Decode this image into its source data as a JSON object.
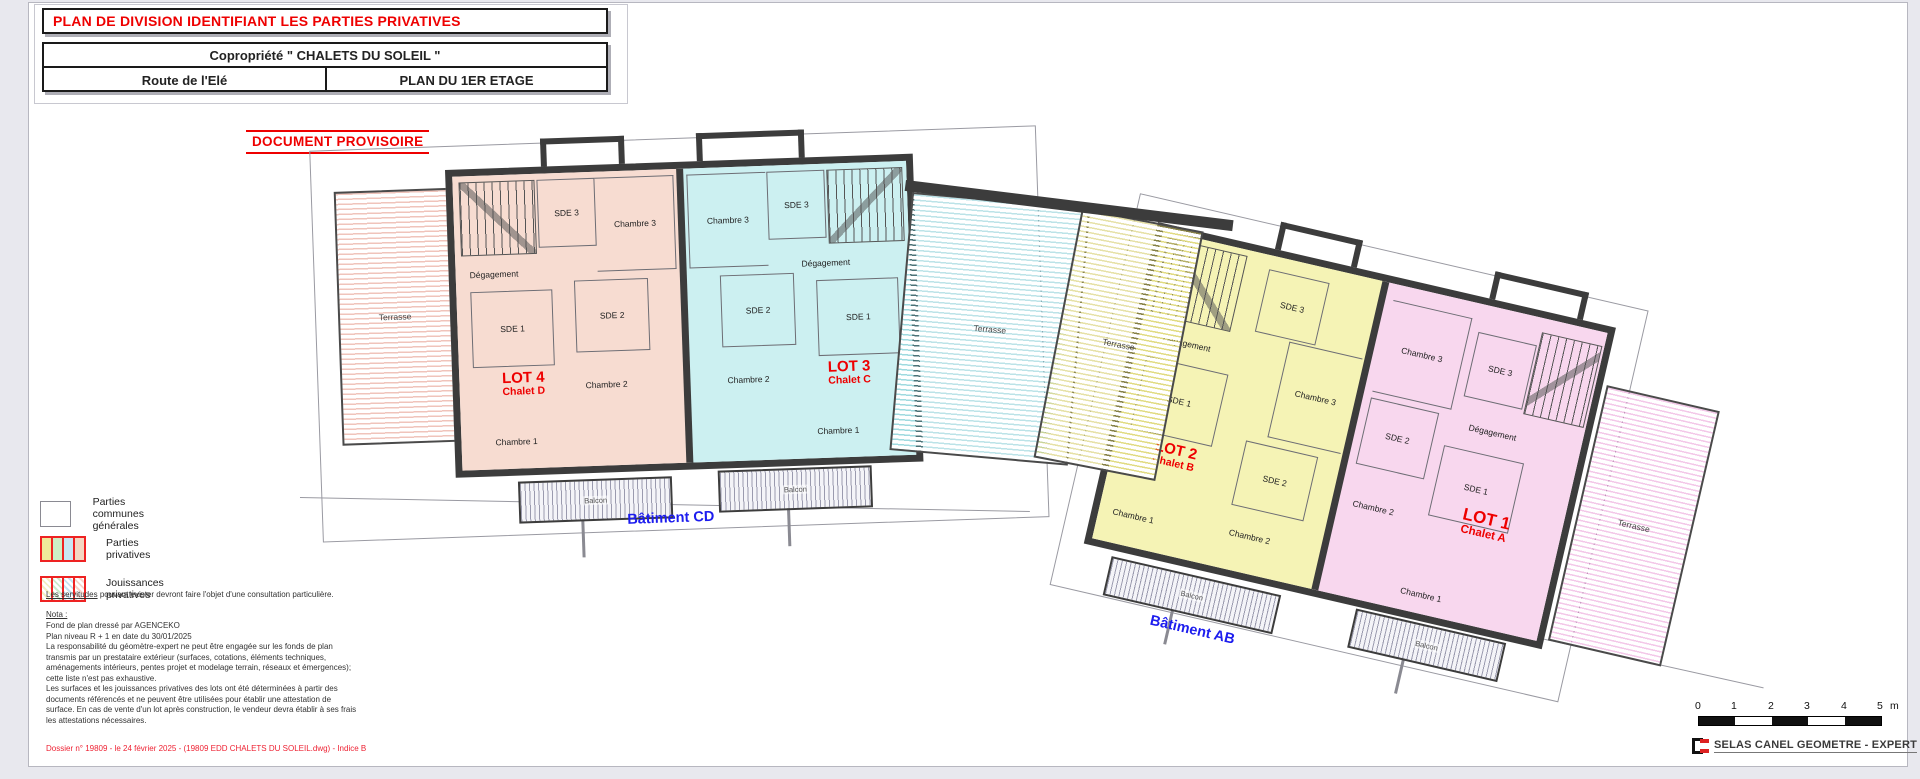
{
  "title_block": {
    "line1": "PLAN DE DIVISION IDENTIFIANT LES PARTIES PRIVATIVES",
    "line2": "Copropriété \" CHALETS DU SOLEIL \"",
    "line3_left": "Route de l'Elé",
    "line3_right": "PLAN DU 1ER ETAGE"
  },
  "stamp": "DOCUMENT PROVISOIRE",
  "colors": {
    "accent_red": "#ee0000",
    "label_blue": "#1c1cee",
    "chalet_d_fill": "#f7dcd1",
    "chalet_c_fill": "#ccf0f1",
    "chalet_b_fill": "#f5f3b5",
    "chalet_a_fill": "#f8d7ee"
  },
  "plan": {
    "batiment_cd": {
      "label": "Bâtiment CD",
      "terrasse_left": "Terrasse",
      "balcons": [
        "Balcon",
        "Balcon"
      ],
      "units": [
        {
          "lot": "LOT 4",
          "chalet": "Chalet D",
          "rooms": {
            "sde3": "SDE 3",
            "chambre3": "Chambre 3",
            "degagement": "Dégagement",
            "sde1": "SDE 1",
            "sde2": "SDE 2",
            "chambre2": "Chambre 2",
            "chambre1": "Chambre 1"
          }
        },
        {
          "lot": "LOT 3",
          "chalet": "Chalet C",
          "rooms": {
            "sde3": "SDE 3",
            "chambre3": "Chambre 3",
            "degagement": "Dégagement",
            "sde1": "SDE 1",
            "sde2": "SDE 2",
            "chambre2": "Chambre 2",
            "chambre1": "Chambre 1"
          }
        }
      ]
    },
    "terrasses_middle": [
      "Terrasse",
      "Terrasse"
    ],
    "batiment_ab": {
      "label": "Bâtiment AB",
      "terrasse_right": "Terrasse",
      "balcons": [
        "Balcon",
        "Balcon"
      ],
      "units": [
        {
          "lot": "LOT 2",
          "chalet": "Chalet B",
          "rooms": {
            "sde3": "SDE 3",
            "chambre3": "Chambre 3",
            "degagement": "Dégagement",
            "sde1": "SDE 1",
            "sde2": "SDE 2",
            "chambre2": "Chambre 2",
            "chambre1": "Chambre 1"
          }
        },
        {
          "lot": "LOT 1",
          "chalet": "Chalet A",
          "rooms": {
            "sde3": "SDE 3",
            "chambre3": "Chambre 3",
            "degagement": "Dégagement",
            "sde1": "SDE 1",
            "sde2": "SDE 2",
            "chambre2": "Chambre 2",
            "chambre1": "Chambre 1"
          }
        }
      ]
    }
  },
  "legend": {
    "items": [
      {
        "label": "Parties communes générales"
      },
      {
        "label": "Parties privatives"
      },
      {
        "label": "Jouissances privatives"
      }
    ]
  },
  "notes": {
    "servitudes_underlined": "Les servitudes",
    "servitudes_rest": " pouvant exister devront faire l'objet d'une consultation particulière.",
    "nota_title": "Nota :",
    "lines": [
      "Fond de plan dressé par AGENCEKO",
      "Plan niveau R + 1 en date du 30/01/2025",
      "La responsabilité du géomètre-expert ne peut être engagée sur les fonds de plan",
      "transmis par un prestataire extérieur (surfaces, cotations, éléments techniques,",
      "aménagements intérieurs, pentes projet et modelage terrain, réseaux et émergences);",
      "cette liste n'est pas exhaustive.",
      "Les surfaces et les jouissances privatives des lots ont été déterminées à partir des",
      "documents référencés et ne peuvent être utilisées pour établir une attestation de",
      "surface. En cas de vente d'un lot après construction, le vendeur devra établir à ses frais",
      "les attestations nécessaires."
    ],
    "dossier": "Dossier n° 19809 - le 24 février 2025   - (19809 EDD CHALETS DU SOLEIL.dwg) - Indice B"
  },
  "scale_bar": {
    "ticks": [
      "0",
      "1",
      "2",
      "3",
      "4",
      "5"
    ],
    "unit": "m"
  },
  "firm": {
    "name": "SELAS CANEL GEOMETRE - EXPERT"
  }
}
